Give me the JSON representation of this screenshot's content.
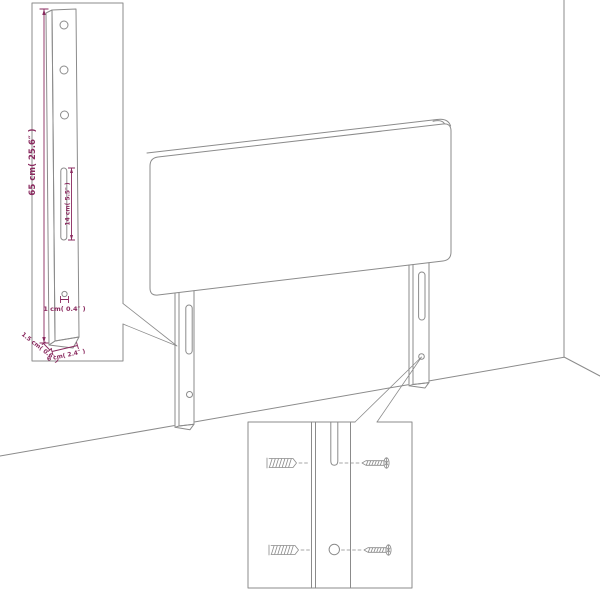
{
  "diagram": {
    "title": "Headboard dimension diagram",
    "type": "product-dimension-drawing",
    "colors": {
      "background": "#ffffff",
      "outline": "#8b8b8b",
      "dimension": "#8a2a5f"
    },
    "labels": {
      "leg_height": "65 cm( 25.6″ )",
      "slot_length": "14 cm( 5.5″ )",
      "bottom_hole_diameter": "1 cm( 0.4″ )",
      "leg_depth": "1.5 cm( 0.6″ )",
      "leg_width": "6 cm( 2.4″ )"
    },
    "callouts": {
      "leg_detail": {
        "hole_count": 3,
        "slot_count": 1
      },
      "mounting_detail": {
        "wall_anchor_count": 2,
        "screw_count": 2
      }
    }
  }
}
